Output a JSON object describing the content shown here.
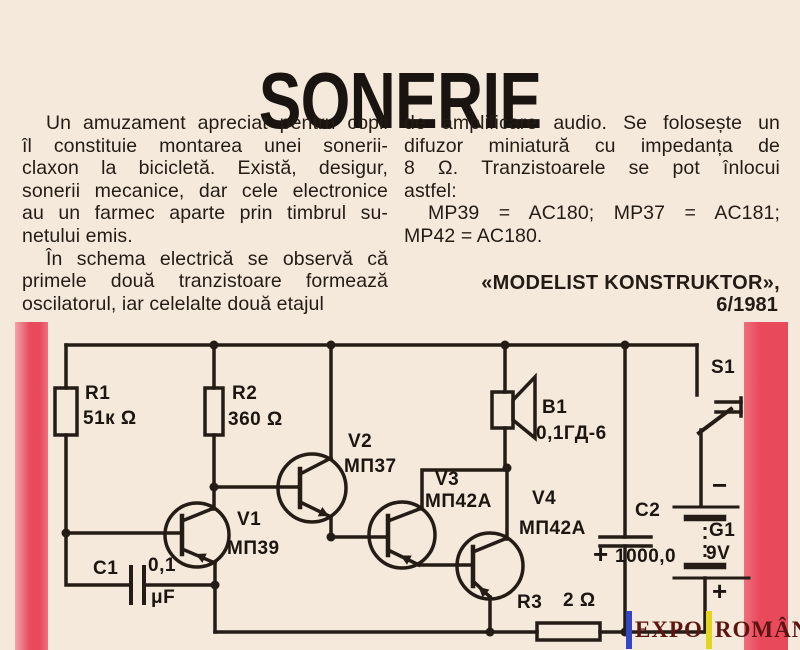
{
  "article": {
    "title": "SONERIE",
    "left_column": {
      "p1_lines": [
        "Un amuzament apreciat pentru copii",
        "îl constituie montarea unei sonerii-",
        "claxon la bicicletă. Există, desigur,",
        "sonerii mecanice, dar cele electronice",
        "au un farmec aparte prin timbrul su-",
        "netului emis."
      ],
      "p2_lines": [
        "În schema electrică se observă că",
        "primele două tranzistoare formează",
        "oscilatorul, iar celelalte două etajul"
      ]
    },
    "right_column": {
      "p1_lines": [
        "de amplificare audio. Se folosește un",
        "difuzor miniatură cu impedanța de",
        "8 Ω. Tranzistoarele se pot înlocui",
        "astfel:"
      ],
      "p2_lines": [
        "MP39 = AC180; MP37 = AC181;",
        "MP42 = AC180."
      ],
      "attribution_line1": "«MODELIST KONSTRUKTOR»,",
      "attribution_line2": "6/1981"
    }
  },
  "circuit": {
    "components": {
      "r1": {
        "name": "R1",
        "value": "51к Ω"
      },
      "r2": {
        "name": "R2",
        "value": "360 Ω"
      },
      "r3": {
        "name": "R3",
        "value": "2 Ω"
      },
      "c1": {
        "name": "C1",
        "value": "0,1",
        "unit": "μF"
      },
      "c2": {
        "name": "C2",
        "value": "1000,0",
        "plus": "+"
      },
      "v1": {
        "name": "V1",
        "type": "МП39"
      },
      "v2": {
        "name": "V2",
        "type": "МП37"
      },
      "v3": {
        "name": "V3",
        "type": "МП42А"
      },
      "v4": {
        "name": "V4",
        "type": "МП42А"
      },
      "b1": {
        "name": "B1",
        "type": "0,1ГД-6"
      },
      "s1": {
        "name": "S1"
      },
      "g1": {
        "name": "G1",
        "value": "9V",
        "minus": "−",
        "plus": "+"
      }
    }
  },
  "watermark": {
    "word1": "EXPO",
    "word2": "ROMÂNIA"
  },
  "colors": {
    "paper": "#f4e9da",
    "ink": "#241c14",
    "red_bar": "#e84a5c",
    "watermark_text": "#5d1512",
    "watermark_blue": "#3347c4",
    "watermark_yellow": "#e3d51f"
  }
}
